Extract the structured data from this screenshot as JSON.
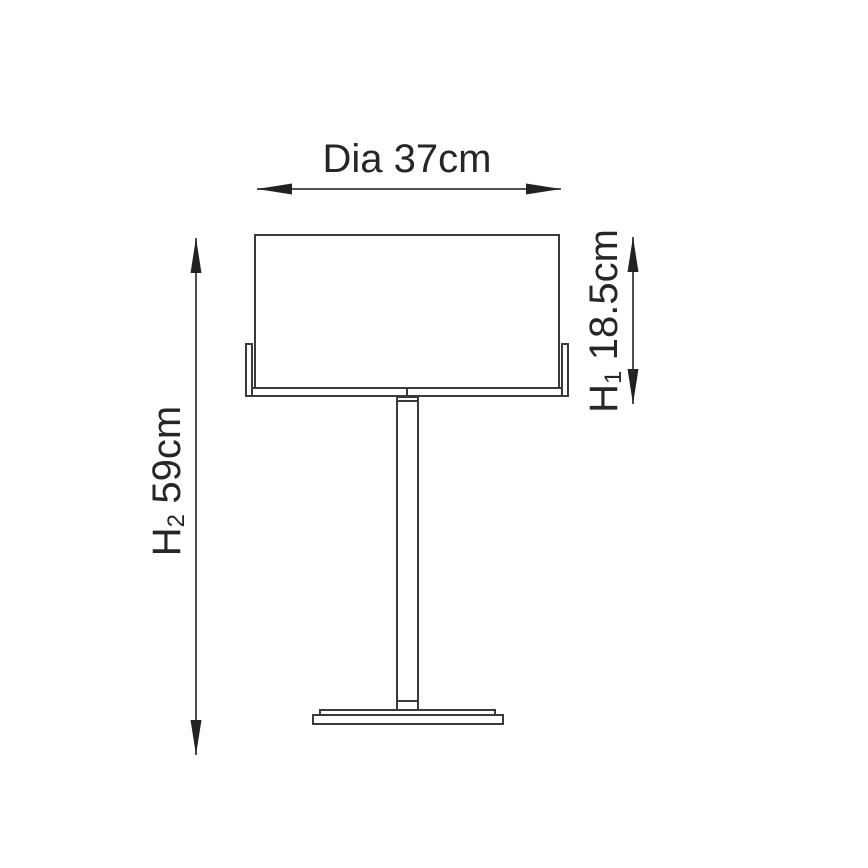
{
  "dimensions": {
    "diameter": {
      "label": "Dia 37cm"
    },
    "shade_height": {
      "symbol": "H",
      "subscript": "1",
      "value": "18.5cm"
    },
    "overall_height": {
      "symbol": "H",
      "subscript": "2",
      "value": "59cm"
    }
  },
  "colors": {
    "line": "#3a3a3a",
    "arrowhead": "#222222",
    "text": "#262626",
    "background": "#ffffff"
  }
}
